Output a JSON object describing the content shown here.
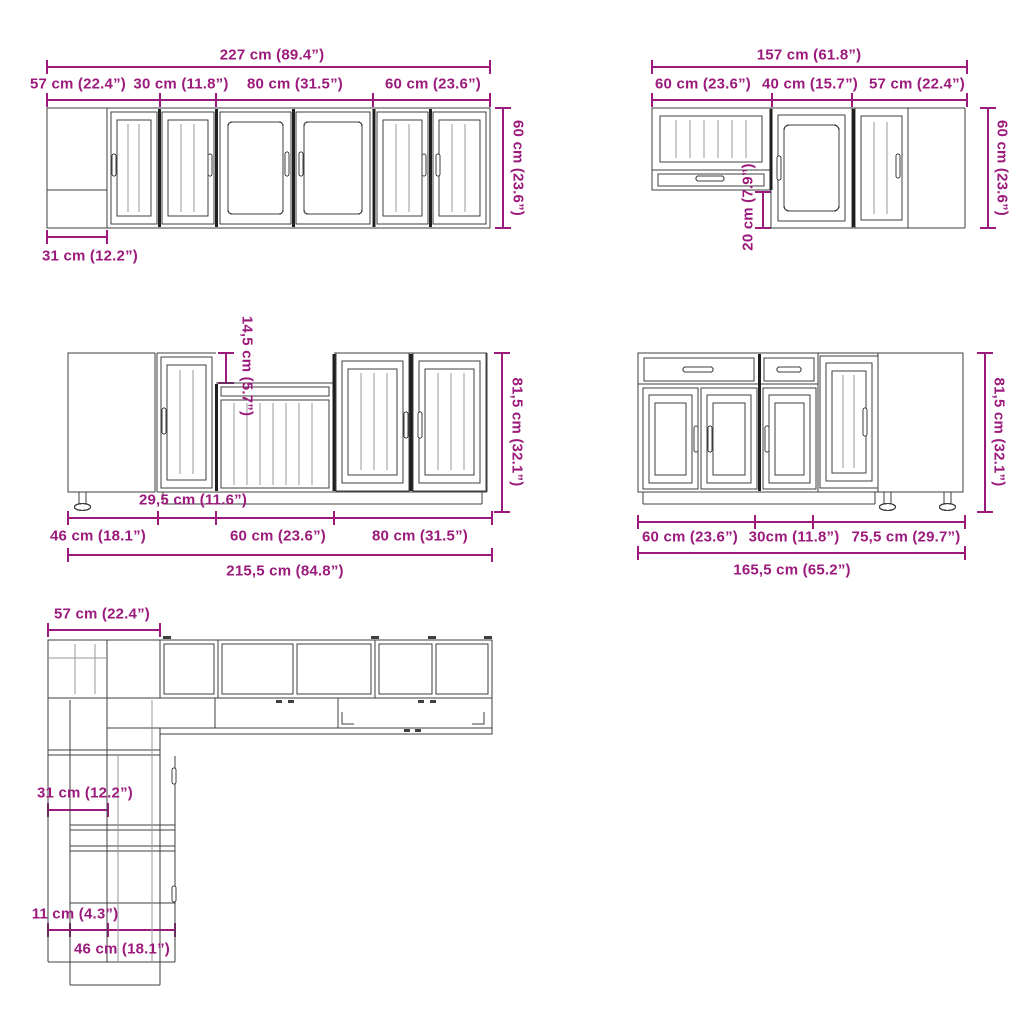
{
  "colors": {
    "dimension": "#9b1a7c",
    "line": "#3f3f3f",
    "background": "#ffffff"
  },
  "views": {
    "wall_run_left": {
      "total_width": "227 cm (89.4”)",
      "segments": [
        "57 cm (22.4”)",
        "30 cm (11.8”)",
        "80 cm (31.5”)",
        "60 cm (23.6”)"
      ],
      "height": "60 cm (23.6”)",
      "depth": "31 cm (12.2”)"
    },
    "wall_run_right": {
      "total_width": "157 cm (61.8”)",
      "segments": [
        "60 cm (23.6”)",
        "40 cm (15.7”)",
        "57 cm (22.4”)"
      ],
      "height": "60 cm (23.6”)",
      "height_offset": "20 cm (7.9”)"
    },
    "base_run_left": {
      "recess_height": "14,5 cm (5.7”)",
      "height": "81,5 cm (32.1”)",
      "segment_inner": "29,5 cm (11.6”)",
      "segments": [
        "46 cm (18.1”)",
        "60 cm (23.6”)",
        "80 cm (31.5”)"
      ],
      "total_width": "215,5 cm (84.8”)"
    },
    "base_run_right": {
      "height": "81,5 cm (32.1”)",
      "segments": [
        "60 cm (23.6”)",
        "30cm (11.8”)",
        "75,5 cm (29.7”)"
      ],
      "total_width": "165,5 cm (65.2”)"
    },
    "plan_view": {
      "corner_width": "57 cm (22.4”)",
      "cabinet_depth": "31 cm (12.2”)",
      "side_gap": "11 cm (4.3”)",
      "base_depth": "46 cm (18.1”)"
    }
  }
}
